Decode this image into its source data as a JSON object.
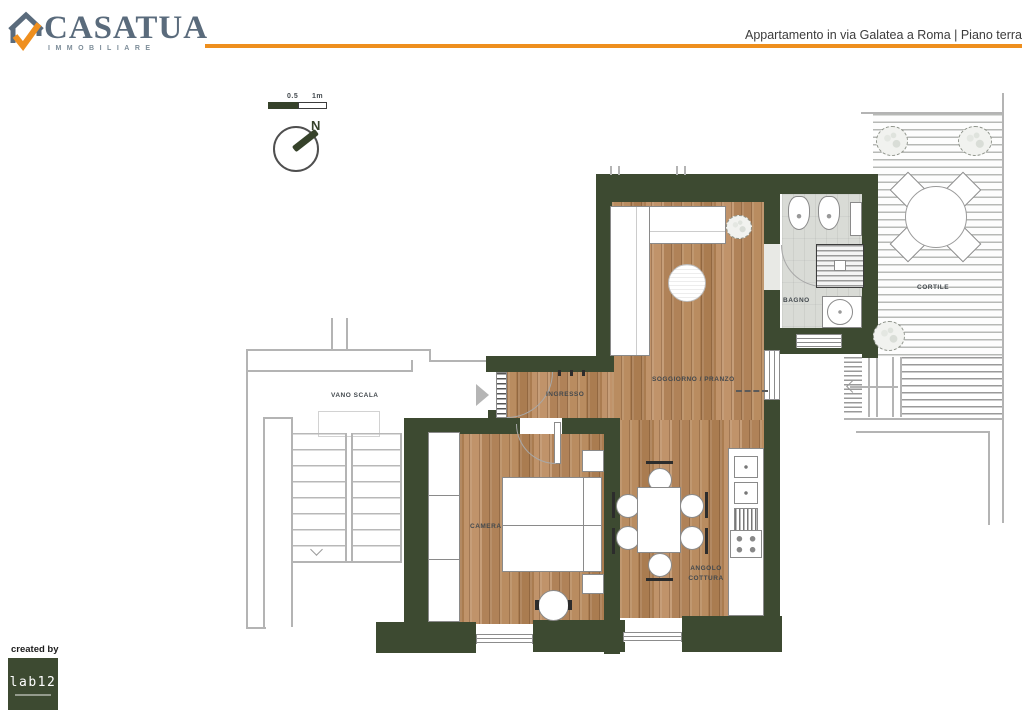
{
  "header": {
    "brand": "CASATUA",
    "brand_sub": "IMMOBILIARE",
    "title": "Appartamento in via Galatea a Roma | Piano terra"
  },
  "scalebar": {
    "half_label": "0.5",
    "full_label": "1m"
  },
  "compass": {
    "north": "N"
  },
  "rooms": {
    "vano_scala": "VANO SCALA",
    "ingresso": "INGRESSO",
    "soggiorno_pranzo": "SOGGIORNO / PRANZO",
    "bagno": "BAGNO",
    "cortile": "CORTILE",
    "camera": "CAMERA",
    "angolo_cottura": "ANGOLO COTTURA"
  },
  "footer": {
    "created_by": "created by",
    "studio_logo": "lab12"
  },
  "colors": {
    "accent_orange": "#ee8f1e",
    "wall_green": "#3d4a31",
    "brand_gray_blue": "#5a6b7c",
    "wood_floor": "#b5895e",
    "bath_tile": "#d9dbd6"
  }
}
